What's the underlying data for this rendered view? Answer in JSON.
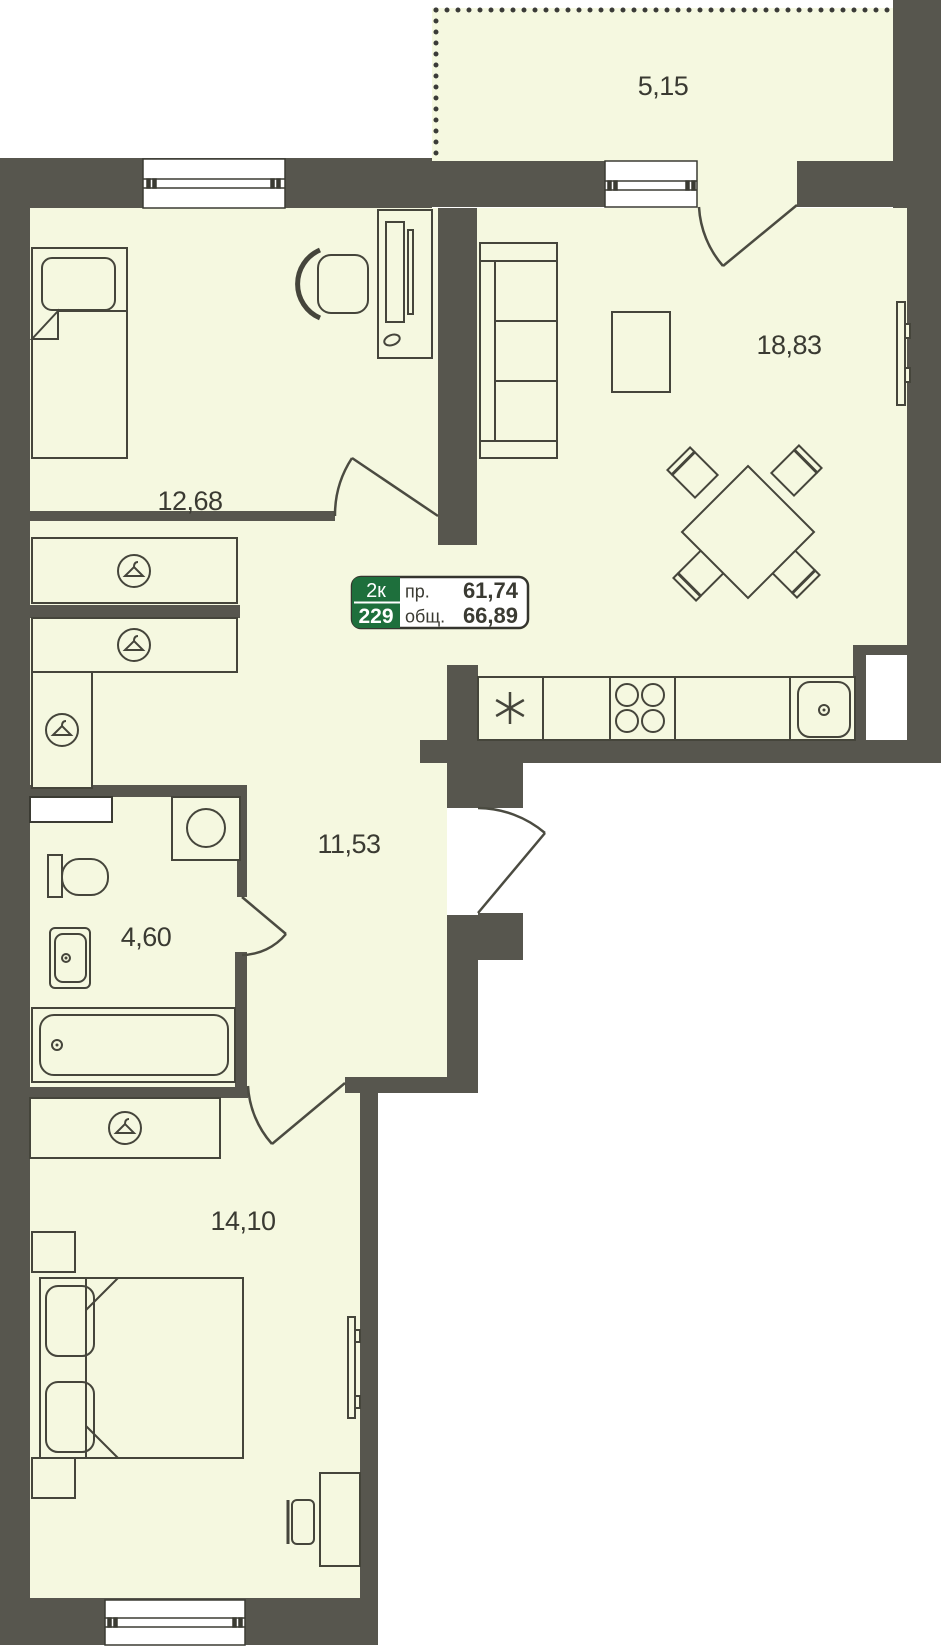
{
  "plan": {
    "labels": {
      "balcony": "5,15",
      "living_room": "18,83",
      "bedroom_top": "12,68",
      "hallway": "11,53",
      "bathroom": "4,60",
      "bedroom_bottom": "14,10"
    },
    "info_box": {
      "type_badge": "2к",
      "unit_number": "229",
      "living_label": "пр.",
      "living_value": "61,74",
      "total_label": "общ.",
      "total_value": "66,89"
    },
    "colors": {
      "wall": "#57564e",
      "floor": "#f5f8e0",
      "outline": "#45453b",
      "badge_green": "#1e6f3c",
      "text": "#3a3a32",
      "white": "#ffffff"
    },
    "icons": {
      "wardrobe": "hanger-icon",
      "fridge": "snowflake-icon",
      "stove": "burners-icon",
      "kitchen_sink": "sink-icon"
    }
  }
}
